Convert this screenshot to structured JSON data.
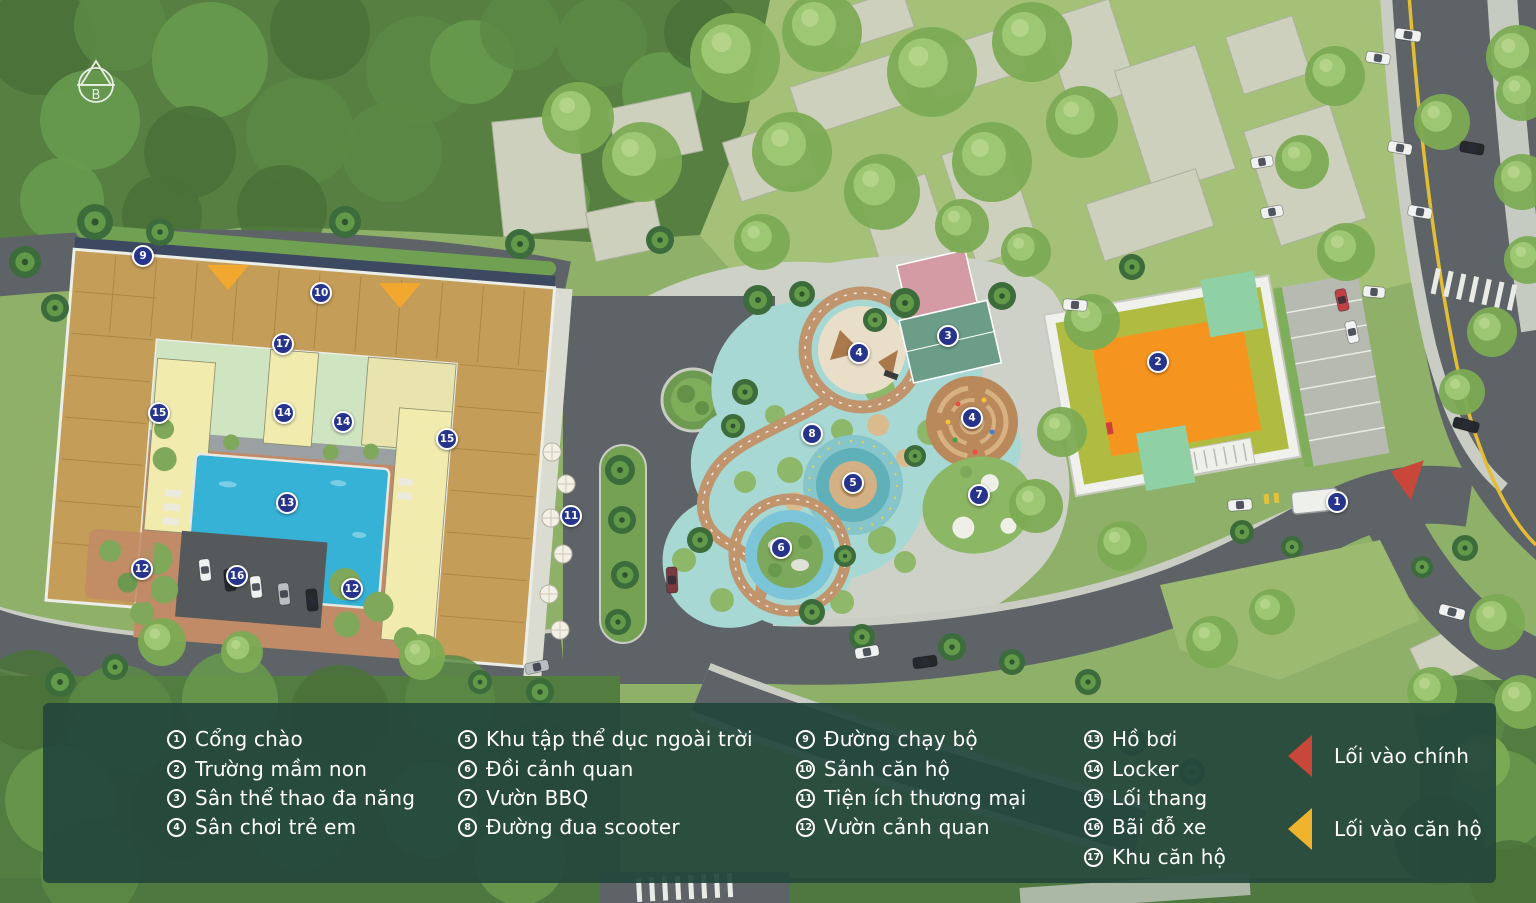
{
  "compass": {
    "label": "B"
  },
  "map": {
    "markers": [
      {
        "num": "1",
        "x": 1337,
        "y": 502
      },
      {
        "num": "2",
        "x": 1158,
        "y": 362
      },
      {
        "num": "3",
        "x": 948,
        "y": 336
      },
      {
        "num": "4",
        "x": 859,
        "y": 353
      },
      {
        "num": "4",
        "x": 972,
        "y": 418
      },
      {
        "num": "5",
        "x": 853,
        "y": 483
      },
      {
        "num": "6",
        "x": 781,
        "y": 548
      },
      {
        "num": "7",
        "x": 979,
        "y": 495
      },
      {
        "num": "8",
        "x": 812,
        "y": 434
      },
      {
        "num": "9",
        "x": 143,
        "y": 256
      },
      {
        "num": "10",
        "x": 321,
        "y": 293
      },
      {
        "num": "11",
        "x": 571,
        "y": 516
      },
      {
        "num": "12",
        "x": 142,
        "y": 569
      },
      {
        "num": "12",
        "x": 352,
        "y": 589
      },
      {
        "num": "13",
        "x": 287,
        "y": 503
      },
      {
        "num": "14",
        "x": 284,
        "y": 413
      },
      {
        "num": "14",
        "x": 343,
        "y": 422
      },
      {
        "num": "15",
        "x": 159,
        "y": 413
      },
      {
        "num": "15",
        "x": 447,
        "y": 439
      },
      {
        "num": "16",
        "x": 237,
        "y": 576
      },
      {
        "num": "17",
        "x": 283,
        "y": 344
      }
    ],
    "entrance_arrows": [
      {
        "kind": "apartment-entrance",
        "x": 228,
        "y": 277,
        "rotation": 0
      },
      {
        "kind": "apartment-entrance",
        "x": 400,
        "y": 295,
        "rotation": 0
      },
      {
        "kind": "main-entrance",
        "x": 1404,
        "y": 476,
        "rotation": 18
      }
    ],
    "colors": {
      "marker": "#27348b",
      "pool": "#35b2d6",
      "apartment_roof": "#c49d58",
      "kindergarten_roof": "#f6941d",
      "amenity_zone": "#a8d8d4",
      "main_entrance_arrow": "#c8473a",
      "apartment_entrance_arrow": "#f2a72e"
    }
  },
  "legend": {
    "items": [
      {
        "num": "1",
        "label": "Cổng chào"
      },
      {
        "num": "2",
        "label": "Trường mầm non"
      },
      {
        "num": "3",
        "label": "Sân thể thao đa năng"
      },
      {
        "num": "4",
        "label": "Sân chơi trẻ em"
      },
      {
        "num": "5",
        "label": "Khu tập thể dục ngoài trời"
      },
      {
        "num": "6",
        "label": "Đồi cảnh quan"
      },
      {
        "num": "7",
        "label": "Vườn BBQ"
      },
      {
        "num": "8",
        "label": "Đường đua scooter"
      },
      {
        "num": "9",
        "label": "Đường chạy bộ"
      },
      {
        "num": "10",
        "label": "Sảnh căn hộ"
      },
      {
        "num": "11",
        "label": "Tiện ích thương mại"
      },
      {
        "num": "12",
        "label": "Vườn cảnh quan"
      },
      {
        "num": "13",
        "label": "Hồ bơi"
      },
      {
        "num": "14",
        "label": "Locker"
      },
      {
        "num": "15",
        "label": "Lối thang"
      },
      {
        "num": "16",
        "label": "Bãi đỗ xe"
      },
      {
        "num": "17",
        "label": "Khu căn hộ"
      }
    ],
    "entrances": [
      {
        "label": "Lối vào chính",
        "color": "#c8473a"
      },
      {
        "label": "Lối vào căn hộ",
        "color": "#f0b32e"
      }
    ]
  }
}
